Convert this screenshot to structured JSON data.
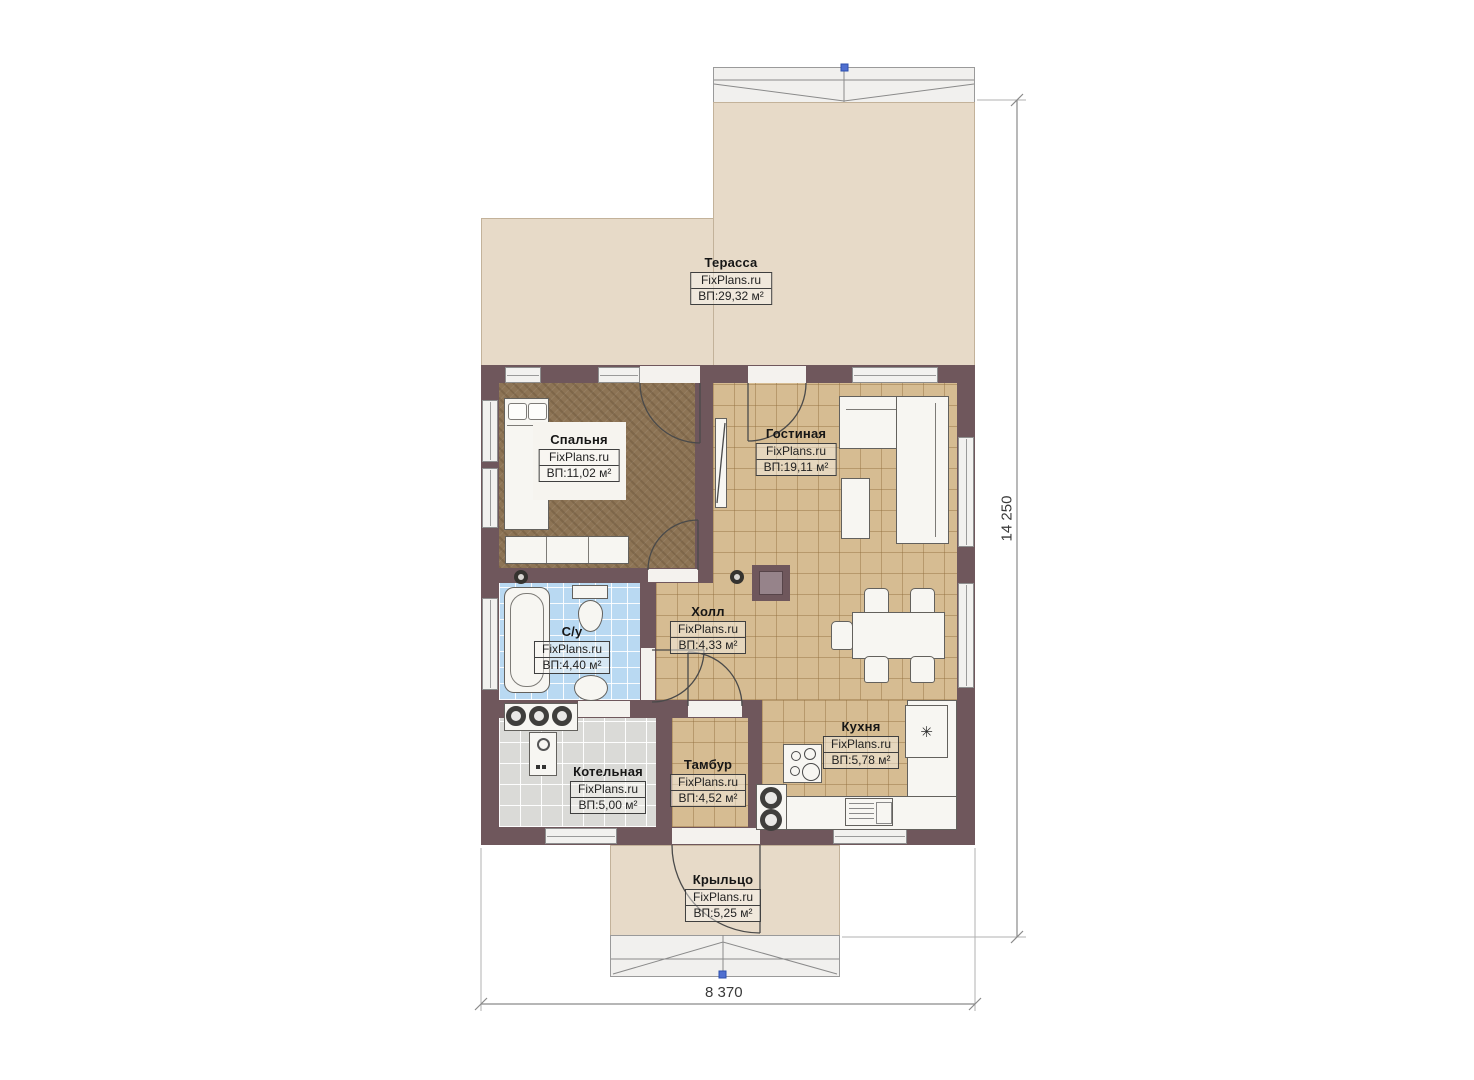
{
  "plan": {
    "rooms": [
      {
        "key": "terrace",
        "name": "Терасса",
        "brand": "FixPlans.ru",
        "area": "ВП:29,32 м²"
      },
      {
        "key": "bedroom",
        "name": "Спальня",
        "brand": "FixPlans.ru",
        "area": "ВП:11,02 м²"
      },
      {
        "key": "living",
        "name": "Гостиная",
        "brand": "FixPlans.ru",
        "area": "ВП:19,11 м²"
      },
      {
        "key": "hall",
        "name": "Холл",
        "brand": "FixPlans.ru",
        "area": "ВП:4,33 м²"
      },
      {
        "key": "bathroom",
        "name": "С/у",
        "brand": "FixPlans.ru",
        "area": "ВП:4,40 м²"
      },
      {
        "key": "boiler",
        "name": "Котельная",
        "brand": "FixPlans.ru",
        "area": "ВП:5,00 м²"
      },
      {
        "key": "vestibule",
        "name": "Тамбур",
        "brand": "FixPlans.ru",
        "area": "ВП:4,52 м²"
      },
      {
        "key": "kitchen",
        "name": "Кухня",
        "brand": "FixPlans.ru",
        "area": "ВП:5,78 м²"
      },
      {
        "key": "porch",
        "name": "Крыльцо",
        "brand": "FixPlans.ru",
        "area": "ВП:5,25 м²"
      }
    ],
    "dimensions": {
      "height_mm": "14 250",
      "width_mm": "8 370"
    },
    "icons": {
      "fridge_star": "✳"
    },
    "colors": {
      "wall": "#6f575c",
      "tile_floor": "#d6bc92",
      "bedroom_floor": "#8d7455",
      "bathroom_floor": "#b9d9f2",
      "boiler_floor": "#dadad7",
      "terrace_floor": "#e7dac8",
      "furniture": "#f7f6f2",
      "grip_marker": "#4f6fd0"
    }
  }
}
